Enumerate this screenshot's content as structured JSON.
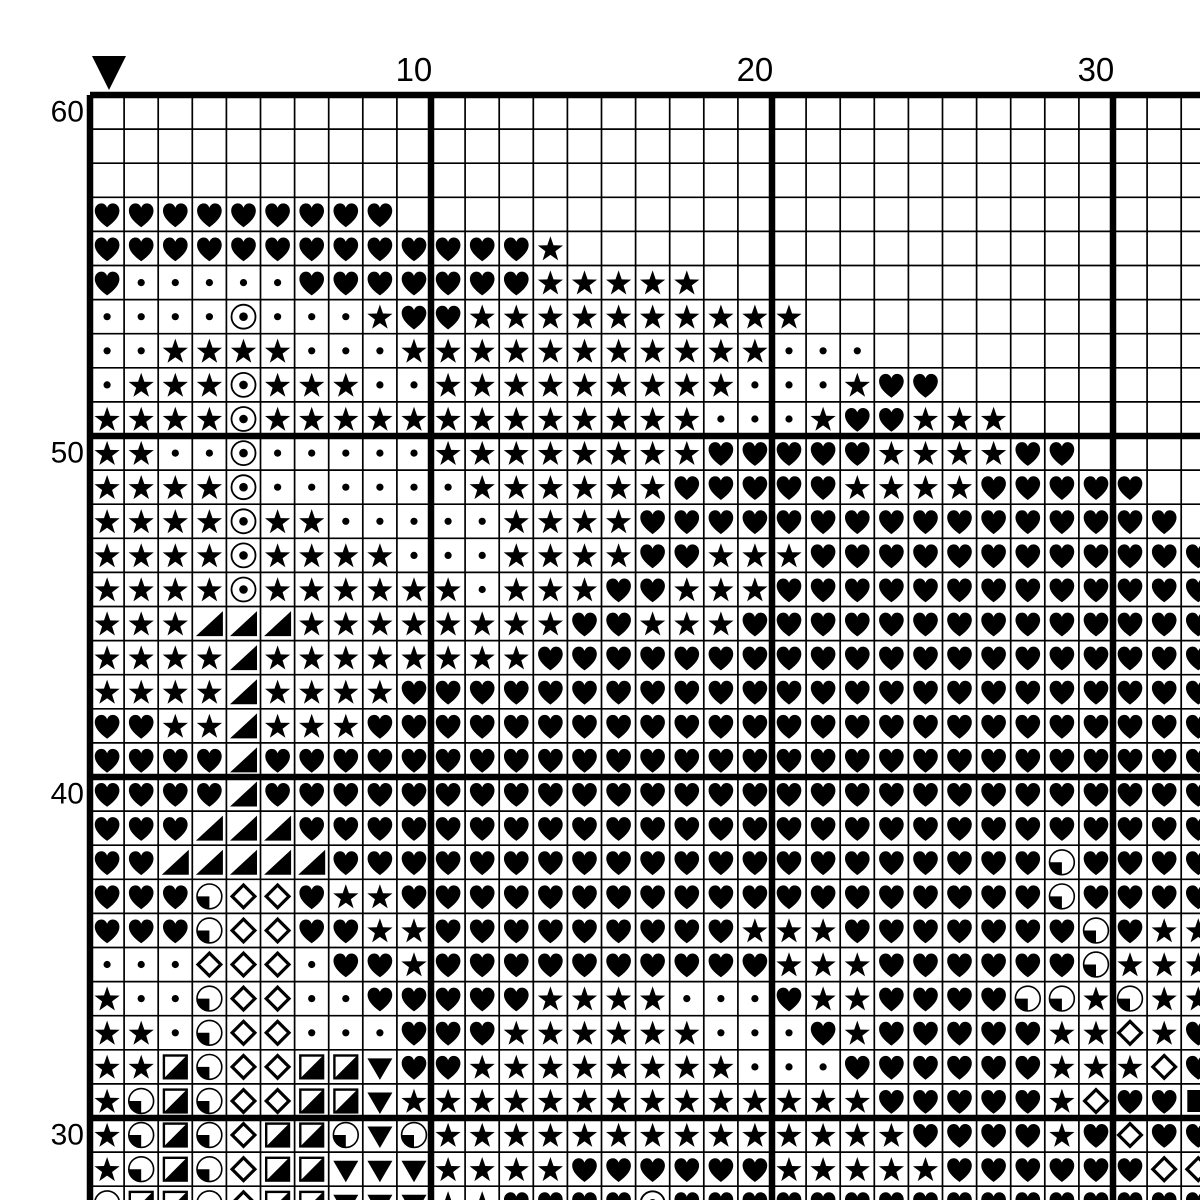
{
  "pattern": {
    "marker": {
      "description": "black downward triangle marking a column",
      "col": 1
    },
    "column_labels": [
      {
        "text": "10",
        "col": 10
      },
      {
        "text": "20",
        "col": 20
      },
      {
        "text": "30",
        "col": 30
      }
    ],
    "row_labels": [
      {
        "text": "60",
        "row_offset": 0
      },
      {
        "text": "50",
        "row_offset": 10
      },
      {
        "text": "40",
        "row_offset": 20
      },
      {
        "text": "30",
        "row_offset": 30
      }
    ]
  },
  "chart_data": {
    "type": "table",
    "description": "Cross-stitch pattern symbol grid. Rows listed top-to-bottom are chart rows 60 down to 28 (bottom row partially cut off by the image edge). Columns 1-33 left-to-right (column 33 partially cut off).",
    "symbol_legend": {
      "H": "black-heart",
      "S": "black-star",
      "d": "small-dot",
      "O": "circle-with-center-dot",
      "T": "black-lower-right-triangle",
      "V": "black-down-triangle",
      "Q": "circle-with-lower-left-quadrant-black",
      "D": "open-diamond-thick",
      "B": "square-with-lower-right-half-black",
      "F": "filled-square",
      ".": "empty"
    },
    "rows": [
      {
        "row": 60,
        "cells": "................................."
      },
      {
        "row": 59,
        "cells": "................................."
      },
      {
        "row": 58,
        "cells": "................................."
      },
      {
        "row": 57,
        "cells": "HHHHHHHHH........................"
      },
      {
        "row": 56,
        "cells": "HHHHHHHHHHHHHS..................."
      },
      {
        "row": 55,
        "cells": "HdddddHHHHHHHSSSSS..............."
      },
      {
        "row": 54,
        "cells": "ddddOdddSHHSSSSSSSSSS............"
      },
      {
        "row": 53,
        "cells": "ddSSSSdddSSSSSSSSSSSddd.........."
      },
      {
        "row": 52,
        "cells": "dSSSOSSSddSSSSSSSSSdddSHH........"
      },
      {
        "row": 51,
        "cells": "SSSSOSSSSSSSSSSSSSdddSHHSSS......"
      },
      {
        "row": 50,
        "cells": "SSddOdddddSSSSSSSSHHHHHSSSSHH...."
      },
      {
        "row": 49,
        "cells": "SSSSOddddddSSSSSSHHHHHSSSSHHHHH.."
      },
      {
        "row": 48,
        "cells": "SSSSOSSdddddSSSSHHHHHHHHHHHHHHHH."
      },
      {
        "row": 47,
        "cells": "SSSSOSSSSdddSSSSHHSSSHHHHHHHHHHHH"
      },
      {
        "row": 46,
        "cells": "SSSSOSSSSSSdSSSHHSSSHHHHHHHHHHHHH"
      },
      {
        "row": 45,
        "cells": "SSSTTTSSSSSSSSHHSSSHHHHHHHHHHHHHH"
      },
      {
        "row": 44,
        "cells": "SSSSTSSSSSSSSHHHHHHHHHHHHHHHHHHHH"
      },
      {
        "row": 43,
        "cells": "SSSSTSSSSHHHHHHHHHHHHHHHHHHHHHHHH"
      },
      {
        "row": 42,
        "cells": "HHSSTSSSHHHHHHHHHHHHHHHHHHHHHHHHH"
      },
      {
        "row": 41,
        "cells": "HHHHTHHHHHHHHHHHHHHHHHHHHHHHHHHHH"
      },
      {
        "row": 40,
        "cells": "HHHHTHHHHHHHHHHHHHHHHHHHHHHHHHHHH"
      },
      {
        "row": 39,
        "cells": "HHHTTTHHHHHHHHHHHHHHHHHHHHHHHHHHH"
      },
      {
        "row": 38,
        "cells": "HHTTTTTHHHHHHHHHHHHHHHHHHHHHQHHHH"
      },
      {
        "row": 37,
        "cells": "HHHQDDHSSHHHHHHHHHHHHHHHHHHHQHHHH"
      },
      {
        "row": 36,
        "cells": "HHHQDDHHSSHHHHHHHHHSSSHHHHHHHQHSS"
      },
      {
        "row": 35,
        "cells": "dddDDDdHHSHHHHHHHHHHSSSHHHHHHQSSS"
      },
      {
        "row": 34,
        "cells": "SddQDDddHHHHHSSSSdddHSSHHHHQQSQSS"
      },
      {
        "row": 33,
        "cells": "SSdQDDdddHHHSSSSSSdddHSHHHHHSSDSH"
      },
      {
        "row": 32,
        "cells": "SSBQDDBBVHHSSSSSSSSdddHHHHHHSSSDH"
      },
      {
        "row": 31,
        "cells": "SQBQDDBBVSSSSSSSSSSSSSSHHHHHSDHHF"
      },
      {
        "row": 30,
        "cells": "SQBQDBBQVQSSSSSSSSSSSSSSHHHHSHDHH"
      },
      {
        "row": 29,
        "cells": "SQBQDBBVVVSSSSHHHHHHSSSSSHHHHHHDD"
      },
      {
        "row": 28,
        "cells": "QBBQDBBVVVSSHHHHOHHHHHHHHHHHHHHHH"
      }
    ]
  },
  "style": {
    "background": "#ffffff",
    "ink": "#000000",
    "cell_px": 34.1,
    "origin_x": 90,
    "origin_y": 94.5,
    "thin_line_px": 1.7,
    "bold_line_px": 6.5,
    "bold_every": 10
  }
}
